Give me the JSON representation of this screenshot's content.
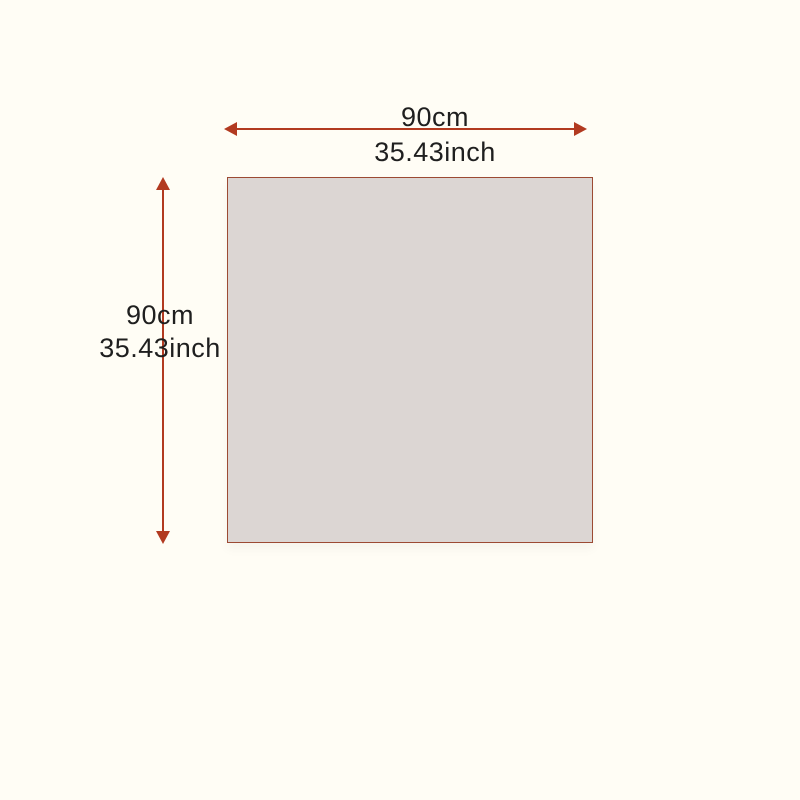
{
  "page": {
    "type": "product-dimension-diagram",
    "background_color": "#fffdf5"
  },
  "square": {
    "fill_color": "#dcd6d3",
    "border_color": "#9c4a33"
  },
  "arrow": {
    "color": "#b23a20"
  },
  "text": {
    "color": "#1f1f1f"
  },
  "dimensions": {
    "width": {
      "cm": "90cm",
      "inch": "35.43inch"
    },
    "height": {
      "cm": "90cm",
      "inch": "35.43inch"
    }
  }
}
